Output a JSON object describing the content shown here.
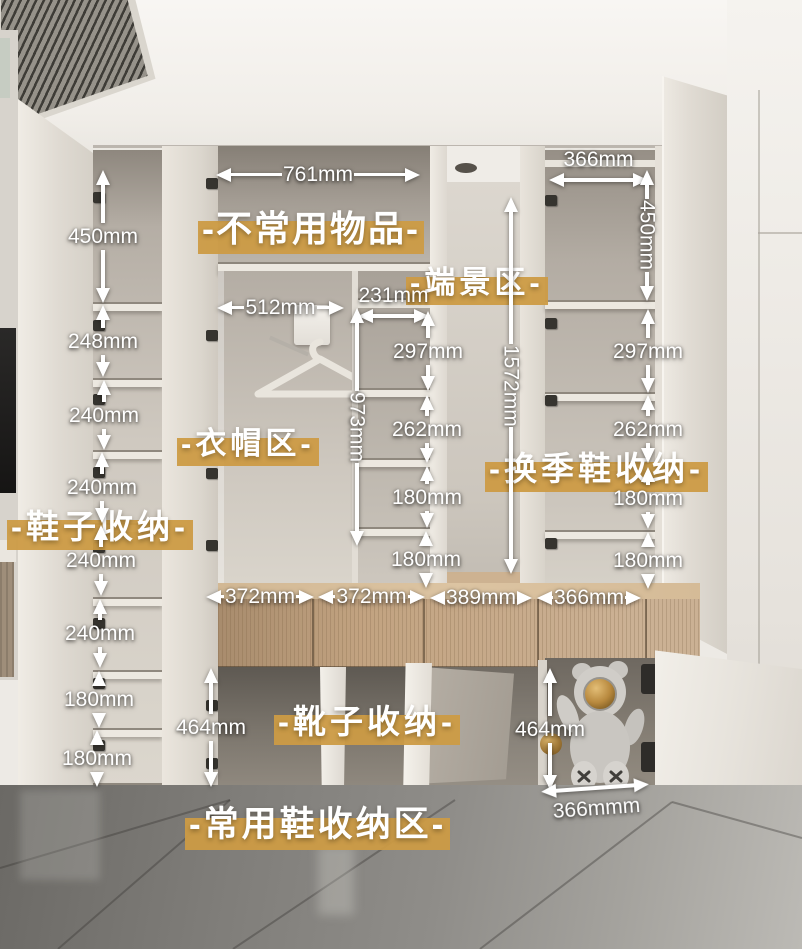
{
  "colors": {
    "highlight_gold": "#CC9B45",
    "dimension_white": "#FFFFFF"
  },
  "zone_labels": [
    {
      "id": "infrequent-items",
      "text": "-不常用物品-",
      "x": 202,
      "y": 206,
      "size": 36,
      "spacing": 2
    },
    {
      "id": "end-view-area",
      "text": "-端景区-",
      "x": 410,
      "y": 264,
      "size": 31,
      "spacing": 4
    },
    {
      "id": "clothing-area",
      "text": "-衣帽区-",
      "x": 181,
      "y": 425,
      "size": 31,
      "spacing": 4
    },
    {
      "id": "shoe-storage",
      "text": "-鞋子收纳-",
      "x": 11,
      "y": 506,
      "size": 33,
      "spacing": 4
    },
    {
      "id": "seasonal-shoe-storage",
      "text": "-换季鞋收纳-",
      "x": 489,
      "y": 448,
      "size": 33,
      "spacing": 4
    },
    {
      "id": "boot-storage",
      "text": "-靴子收纳-",
      "x": 278,
      "y": 701,
      "size": 33,
      "spacing": 4
    },
    {
      "id": "daily-shoe-storage-area",
      "text": "-常用鞋收纳区-",
      "x": 189,
      "y": 803,
      "size": 35,
      "spacing": 3
    }
  ],
  "dimensions": [
    {
      "text": "450mm",
      "orient": "v",
      "x": 103,
      "y": 170,
      "len": 133
    },
    {
      "text": "248mm",
      "orient": "v",
      "x": 103,
      "y": 305,
      "len": 72
    },
    {
      "text": "240mm",
      "orient": "v",
      "x": 104,
      "y": 380,
      "len": 70
    },
    {
      "text": "240mm",
      "orient": "v",
      "x": 102,
      "y": 452,
      "len": 71
    },
    {
      "text": "240mm",
      "orient": "v",
      "x": 101,
      "y": 525,
      "len": 71
    },
    {
      "text": "240mm",
      "orient": "v",
      "x": 100,
      "y": 599,
      "len": 69
    },
    {
      "text": "180mm",
      "orient": "v",
      "x": 99,
      "y": 671,
      "len": 57
    },
    {
      "text": "180mm",
      "orient": "v",
      "x": 97,
      "y": 730,
      "len": 54
    },
    {
      "text": "761mm",
      "orient": "h",
      "x": 216,
      "y": 172,
      "len": 204
    },
    {
      "text": "512mm",
      "orient": "h",
      "x": 217,
      "y": 305,
      "len": 127
    },
    {
      "text": "231mm",
      "orient": "ha",
      "x": 358,
      "y": 308,
      "len": 71
    },
    {
      "text": "366mm",
      "orient": "ha",
      "x": 549,
      "y": 172,
      "len": 99
    },
    {
      "text": "450mm",
      "orient": "vr",
      "x": 647,
      "y": 170,
      "len": 131
    },
    {
      "text": "297mm",
      "orient": "v",
      "x": 428,
      "y": 311,
      "len": 80
    },
    {
      "text": "262mm",
      "orient": "v",
      "x": 427,
      "y": 395,
      "len": 68
    },
    {
      "text": "180mm",
      "orient": "v",
      "x": 427,
      "y": 466,
      "len": 62
    },
    {
      "text": "180mm",
      "orient": "v",
      "x": 426,
      "y": 531,
      "len": 47
    },
    {
      "text": "297mm",
      "orient": "v",
      "x": 648,
      "y": 309,
      "len": 84
    },
    {
      "text": "262mm",
      "orient": "v",
      "x": 648,
      "y": 395,
      "len": 68
    },
    {
      "text": "180mm",
      "orient": "v",
      "x": 648,
      "y": 467,
      "len": 62
    },
    {
      "text": "180mm",
      "orient": "v",
      "x": 648,
      "y": 532,
      "len": 49
    },
    {
      "text": "973mm",
      "orient": "vr",
      "x": 357,
      "y": 308,
      "len": 238
    },
    {
      "text": "1572mm",
      "orient": "vr",
      "x": 511,
      "y": 197,
      "len": 377
    },
    {
      "text": "372mm",
      "orient": "h",
      "x": 206,
      "y": 594,
      "len": 108
    },
    {
      "text": "372mm",
      "orient": "h",
      "x": 318,
      "y": 594,
      "len": 107
    },
    {
      "text": "389mm",
      "orient": "h",
      "x": 430,
      "y": 595,
      "len": 102
    },
    {
      "text": "366mm",
      "orient": "h",
      "x": 537,
      "y": 595,
      "len": 104
    },
    {
      "text": "464mm",
      "orient": "v",
      "x": 211,
      "y": 668,
      "len": 119
    },
    {
      "text": "464mm",
      "orient": "v",
      "x": 550,
      "y": 668,
      "len": 122
    },
    {
      "text": "366mmm",
      "orient": "hb",
      "x": 542,
      "y": 783,
      "len": 108,
      "rot": -4
    }
  ]
}
